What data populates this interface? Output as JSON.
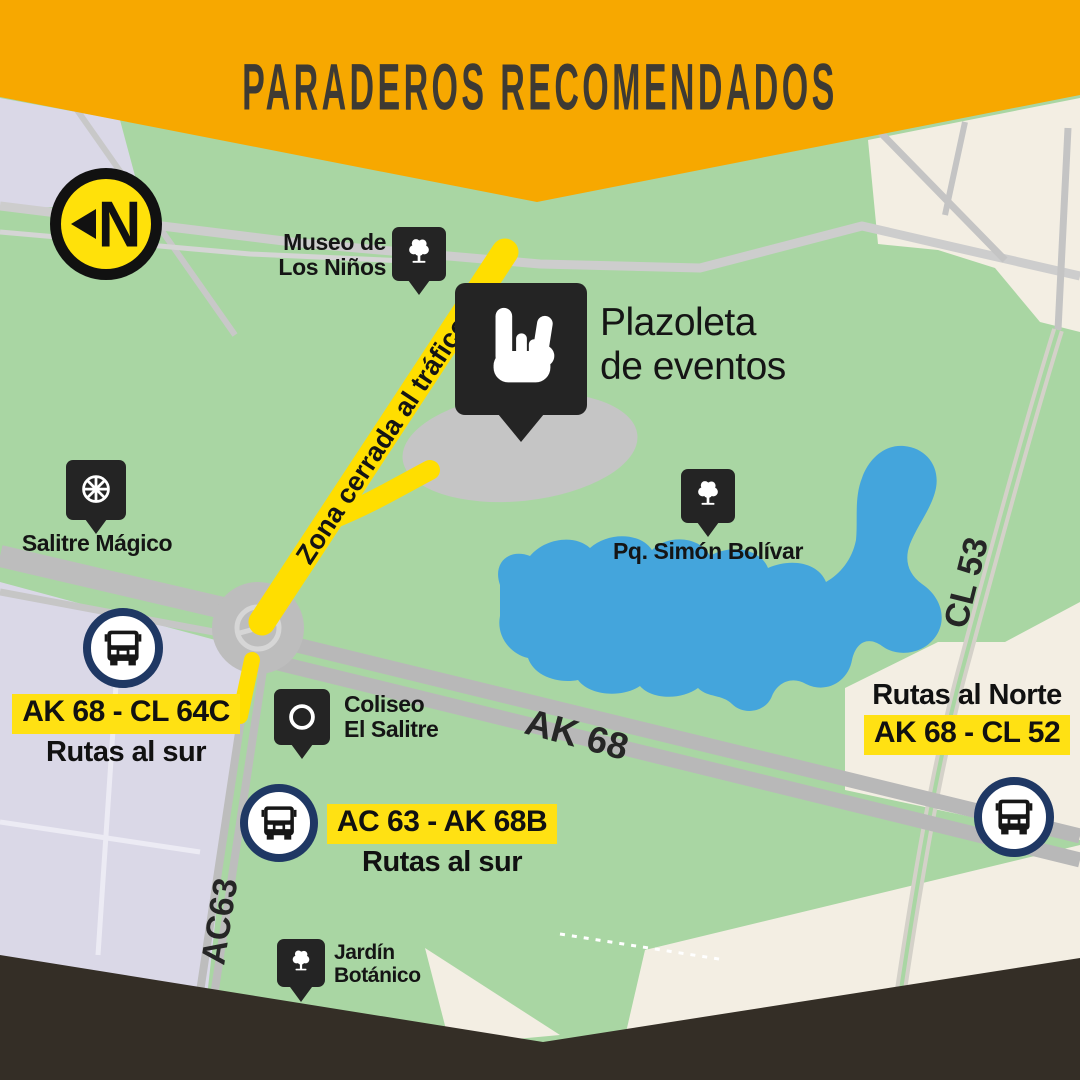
{
  "page": {
    "title": "PARADEROS RECOMENDADOS"
  },
  "north_badge": {
    "letter": "N"
  },
  "pois": {
    "museo": {
      "line1": "Museo de",
      "line2": "Los Niños"
    },
    "plazoleta": {
      "line1": "Plazoleta",
      "line2": "de eventos"
    },
    "salitre_magico": {
      "label": "Salitre Mágico"
    },
    "pq_simon_bolivar": {
      "label": "Pq. Simón Bolívar"
    },
    "coliseo": {
      "line1": "Coliseo",
      "line2": "El Salitre"
    },
    "jardin_botanico": {
      "line1": "Jardín",
      "line2": "Botánico"
    }
  },
  "roads": {
    "ak68": "AK 68",
    "ac63": "AC63",
    "cl53": "CL 53",
    "closed_zone": "Zona cerrada al tráfico"
  },
  "stops": {
    "west": {
      "code": "AK 68 - CL 64C",
      "note": "Rutas al sur"
    },
    "south": {
      "code": "AC 63 - AK 68B",
      "note": "Rutas al sur"
    },
    "north": {
      "note": "Rutas al Norte",
      "code": "AK 68 - CL 52"
    }
  },
  "colors": {
    "banner": "#F7A800",
    "footer": "#342E26",
    "park": "#A9D6A3",
    "urban_left": "#DAD8E7",
    "urban_right": "#F3EEE3",
    "water": "#44A5DC",
    "road": "#BDBDBD",
    "closed_road": "#FFDE00",
    "highlight": "#FFE113",
    "marker": "#242424",
    "bus_ring": "#1F3864"
  }
}
